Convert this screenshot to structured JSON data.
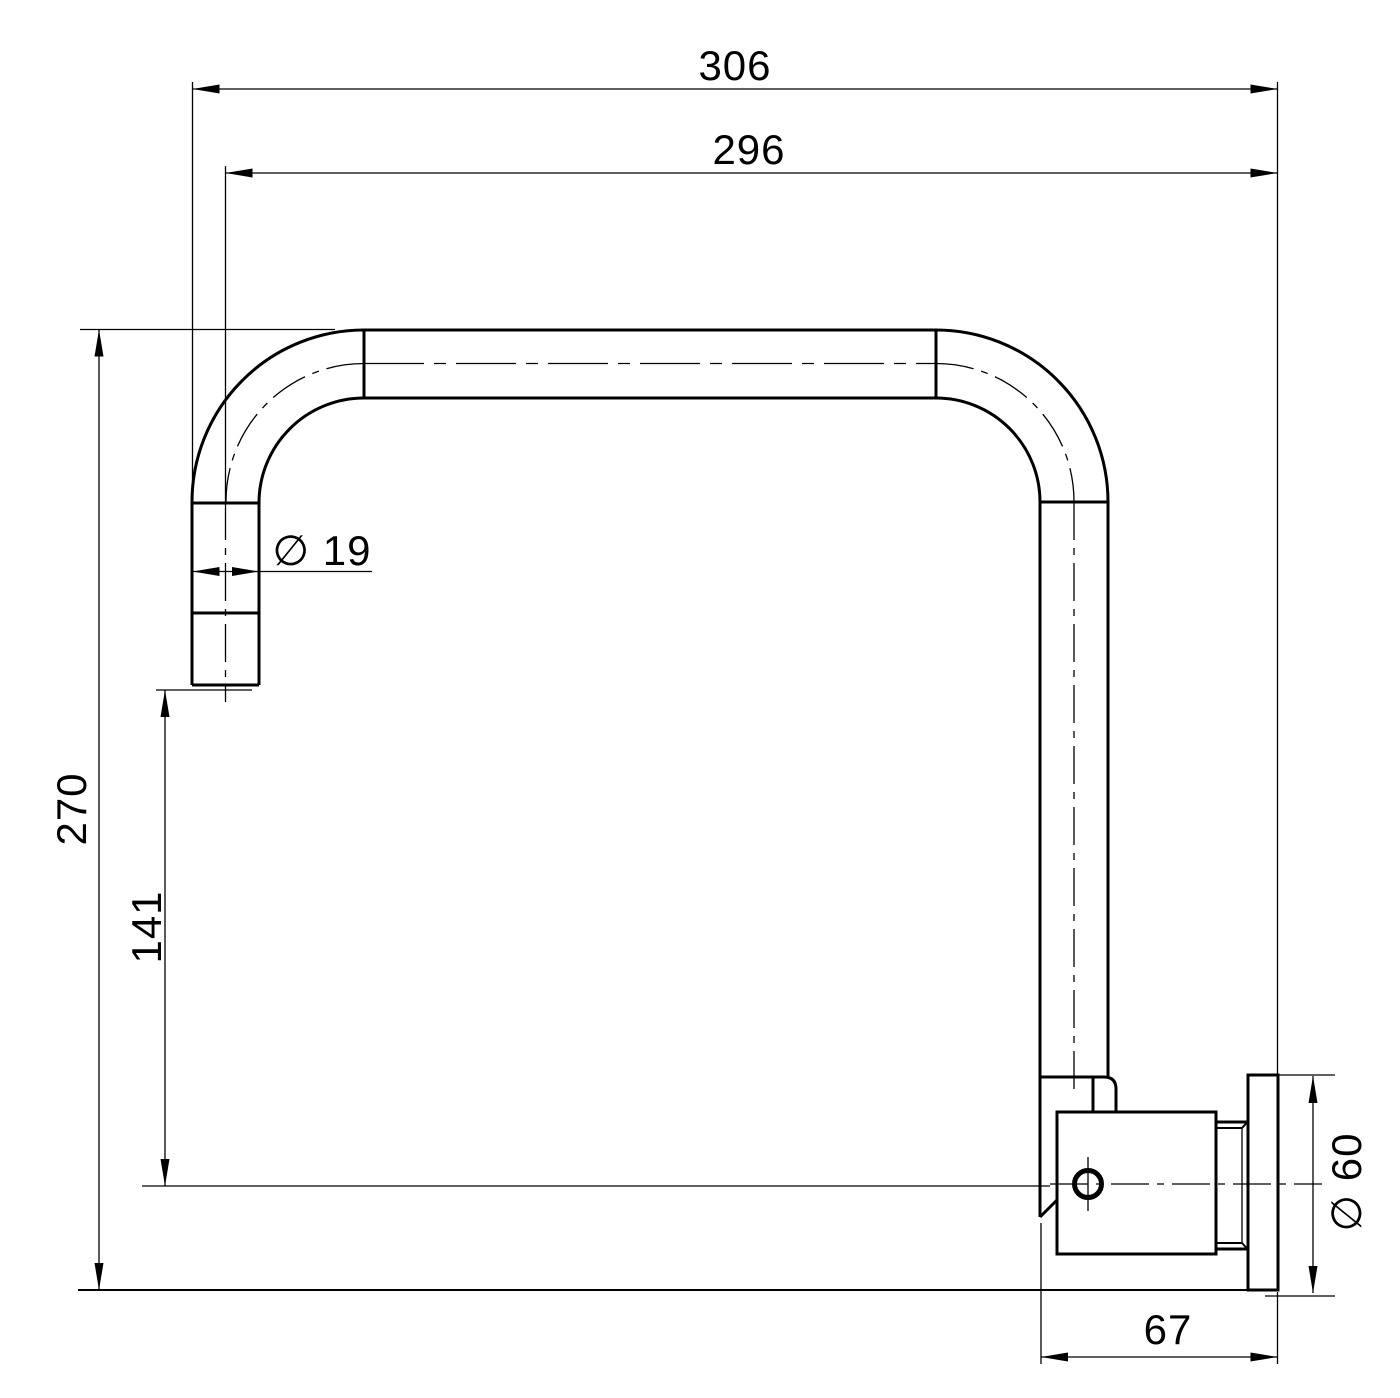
{
  "drawing": {
    "type": "technical-dimension-drawing",
    "subject": "wall-mounted gooseneck spout side elevation",
    "colors": {
      "line": "#000000",
      "background": "#ffffff"
    },
    "dimensions": {
      "overall_width": "306",
      "centerline_width": "296",
      "overall_height": "270",
      "outlet_height": "141",
      "spout_diameter": "∅ 19",
      "flange_diameter": "∅ 60",
      "wall_projection": "67"
    }
  }
}
